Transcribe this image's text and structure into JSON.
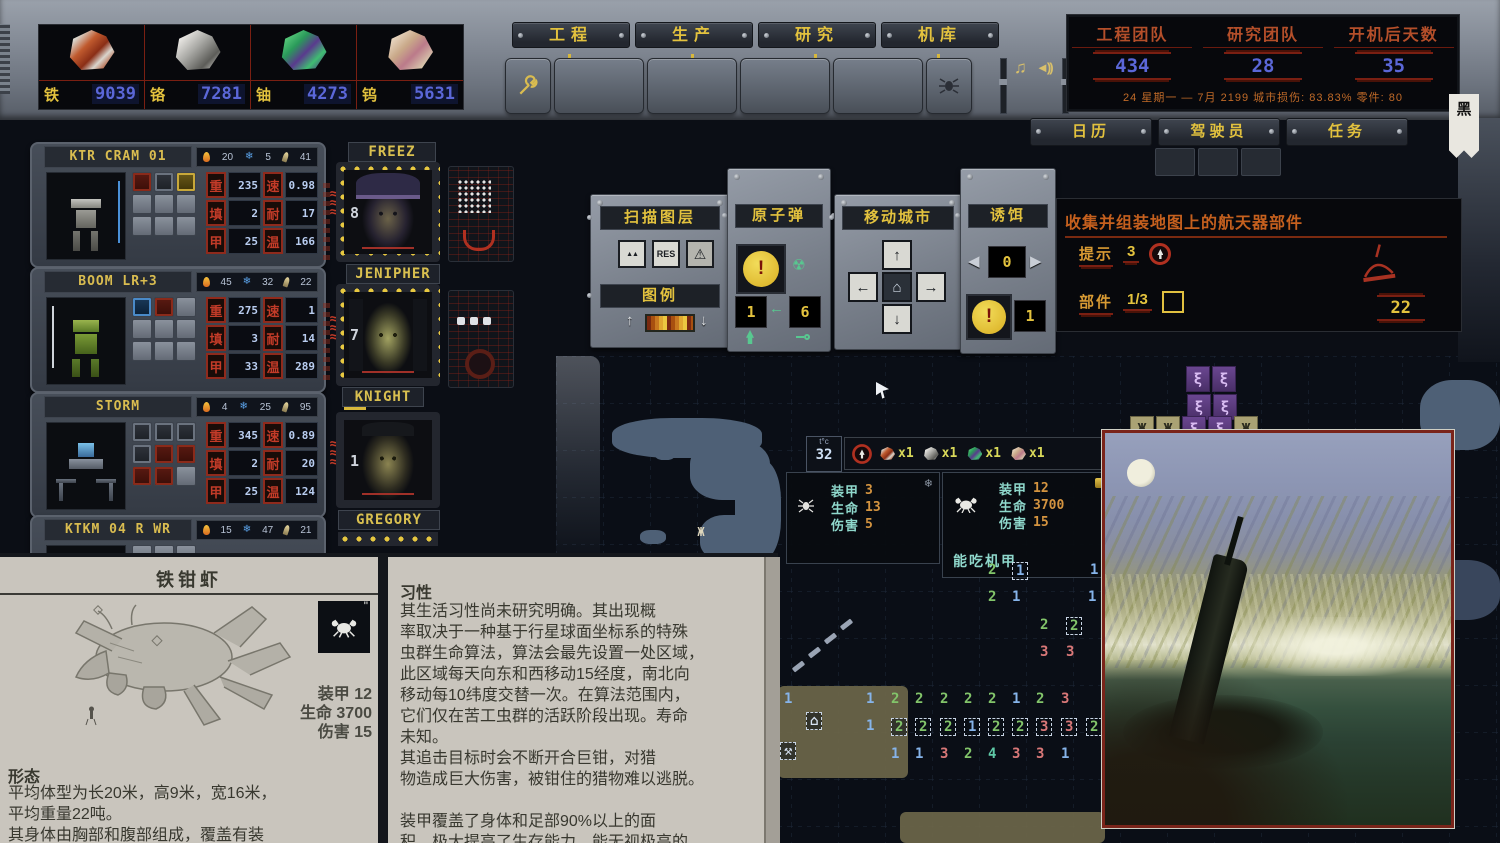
{
  "ui": {
    "stat_labels": {
      "w": "重",
      "s": "速",
      "f": "填",
      "n": "耐",
      "a": "甲",
      "t": "温"
    },
    "icons": {
      "music": "♫",
      "speaker": "◄))",
      "warning": "⚠",
      "mountains": "▲▲",
      "res": "RES",
      "arrow_up": "↑",
      "arrow_down": "↓",
      "arrow_left": "←",
      "arrow_right": "→",
      "home": "⌂",
      "tri_left": "◀",
      "tri_right": "▶",
      "radiation": "☢",
      "banner": "黑",
      "snow": "❄"
    }
  },
  "resources": [
    {
      "name": "铁",
      "value": "9039",
      "cls": "iron"
    },
    {
      "name": "铬",
      "value": "7281",
      "cls": "chrome"
    },
    {
      "name": "铀",
      "value": "4273",
      "cls": "uranium"
    },
    {
      "name": "钨",
      "value": "5631",
      "cls": "tungsten"
    }
  ],
  "tabs": [
    {
      "label": "工程"
    },
    {
      "label": "生产"
    },
    {
      "label": "研究"
    },
    {
      "label": "机库"
    }
  ],
  "counters": {
    "items": [
      {
        "label": "工程团队",
        "value": "434"
      },
      {
        "label": "研究团队",
        "value": "28"
      },
      {
        "label": "开机后天数",
        "value": "35"
      }
    ],
    "status_line": "24 星期一 — 7月 2199  城市损伤: 83.83%  零件: 80"
  },
  "menu_buttons": [
    {
      "label": "日历"
    },
    {
      "label": "驾驶员"
    },
    {
      "label": "任务"
    }
  ],
  "mechs": [
    {
      "name": "KTR CRAM 01",
      "heat": "20",
      "cold": "5",
      "ammo": "41",
      "mods": "m-red m-gray m-yellow",
      "stats": {
        "weight": "235",
        "speed": "0.98",
        "reload": "2",
        "endurance": "17",
        "armor": "25",
        "temp": "166"
      }
    },
    {
      "name": "BOOM LR+3",
      "heat": "45",
      "cold": "32",
      "ammo": "22",
      "mods": "m-blue m-red",
      "stats": {
        "weight": "275",
        "speed": "1",
        "reload": "3",
        "endurance": "14",
        "armor": "33",
        "temp": "289"
      }
    },
    {
      "name": "STORM",
      "heat": "4",
      "cold": "25",
      "ammo": "95",
      "mods": "m-gray m-gray m-gray m-gray m-red m-red m-red m-red",
      "stats": {
        "weight": "345",
        "speed": "0.89",
        "reload": "2",
        "endurance": "20",
        "armor": "25",
        "temp": "124"
      }
    },
    {
      "name": "KTKM 04 R WR",
      "heat": "15",
      "cold": "47",
      "ammo": "21",
      "mods": "",
      "stats": {
        "weight": "",
        "speed": "",
        "reload": "",
        "endurance": "",
        "armor": "",
        "temp": ""
      }
    }
  ],
  "pilots": [
    {
      "name": "FREEZ",
      "level": "8"
    },
    {
      "name": "JENIPHER",
      "level": "7"
    },
    {
      "name": "KNIGHT",
      "level": "1"
    },
    {
      "name": "GREGORY",
      "level": ""
    }
  ],
  "panels": {
    "scan": {
      "title": "扫描图层",
      "res_label": "RES"
    },
    "legend": {
      "title": "图例"
    },
    "atomic": {
      "title": "原子弹",
      "ready": "1",
      "stock": "6",
      "alert": "!"
    },
    "move_city": {
      "title": "移动城市"
    },
    "decoy": {
      "title": "诱饵",
      "selected": "0",
      "stock": "1",
      "alert": "!"
    }
  },
  "quest": {
    "title": "收集并组装地图上的航天器部件",
    "hint_label": "提示",
    "hint_value": "3",
    "parts_label": "部件",
    "parts_value": "1/3",
    "days_left": "22"
  },
  "map": {
    "tile_info": {
      "label": "t°c",
      "value": "32"
    },
    "loot": [
      {
        "cls": "iron",
        "qty": "x1"
      },
      {
        "cls": "chrome",
        "qty": "x1"
      },
      {
        "cls": "uranium",
        "qty": "x1"
      },
      {
        "cls": "tungsten",
        "qty": "x1"
      }
    ],
    "creature_small": {
      "armor_label": "装甲",
      "armor": "3",
      "hp_label": "生命",
      "hp": "13",
      "dmg_label": "伤害",
      "dmg": "5"
    },
    "creature_big": {
      "armor_label": "装甲",
      "armor": "12",
      "hp_label": "生命",
      "hp": "3700",
      "dmg_label": "伤害",
      "dmg": "15",
      "note": "能吃机甲"
    },
    "cells": [
      {
        "x": 988,
        "y": 562,
        "v": "2",
        "c": "g"
      },
      {
        "x": 1012,
        "y": 562,
        "v": "1",
        "c": "b",
        "bx": 1
      },
      {
        "x": 1090,
        "y": 562,
        "v": "1",
        "c": "b"
      },
      {
        "x": 988,
        "y": 589,
        "v": "2",
        "c": "g"
      },
      {
        "x": 1012,
        "y": 589,
        "v": "1",
        "c": "b"
      },
      {
        "x": 1088,
        "y": 589,
        "v": "1",
        "c": "b"
      },
      {
        "x": 1040,
        "y": 617,
        "v": "2",
        "c": "g"
      },
      {
        "x": 1066,
        "y": 617,
        "v": "2",
        "c": "g",
        "bx": 1
      },
      {
        "x": 1040,
        "y": 644,
        "v": "3",
        "c": "r"
      },
      {
        "x": 1066,
        "y": 644,
        "v": "3",
        "c": "r"
      },
      {
        "x": 784,
        "y": 691,
        "v": "1",
        "c": "b"
      },
      {
        "x": 866,
        "y": 691,
        "v": "1",
        "c": "b"
      },
      {
        "x": 891,
        "y": 691,
        "v": "2",
        "c": "g"
      },
      {
        "x": 915,
        "y": 691,
        "v": "2",
        "c": "g"
      },
      {
        "x": 940,
        "y": 691,
        "v": "2",
        "c": "g"
      },
      {
        "x": 964,
        "y": 691,
        "v": "2",
        "c": "g"
      },
      {
        "x": 988,
        "y": 691,
        "v": "2",
        "c": "g"
      },
      {
        "x": 1012,
        "y": 691,
        "v": "1",
        "c": "b"
      },
      {
        "x": 1036,
        "y": 691,
        "v": "2",
        "c": "g"
      },
      {
        "x": 1061,
        "y": 691,
        "v": "3",
        "c": "r"
      },
      {
        "x": 806,
        "y": 712,
        "v": "⌂",
        "c": "w",
        "bx": 1
      },
      {
        "x": 866,
        "y": 718,
        "v": "1",
        "c": "b"
      },
      {
        "x": 891,
        "y": 718,
        "v": "2",
        "c": "g",
        "bx": 1
      },
      {
        "x": 915,
        "y": 718,
        "v": "2",
        "c": "g",
        "bx": 1
      },
      {
        "x": 940,
        "y": 718,
        "v": "2",
        "c": "g",
        "bx": 1
      },
      {
        "x": 964,
        "y": 718,
        "v": "1",
        "c": "b",
        "bx": 1
      },
      {
        "x": 988,
        "y": 718,
        "v": "2",
        "c": "g",
        "bx": 1
      },
      {
        "x": 1012,
        "y": 718,
        "v": "2",
        "c": "g",
        "bx": 1
      },
      {
        "x": 1036,
        "y": 718,
        "v": "3",
        "c": "r",
        "bx": 1
      },
      {
        "x": 1061,
        "y": 718,
        "v": "3",
        "c": "r",
        "bx": 1
      },
      {
        "x": 1086,
        "y": 718,
        "v": "2",
        "c": "g",
        "bx": 1
      },
      {
        "x": 780,
        "y": 742,
        "v": "⚒",
        "c": "w",
        "bx": 1
      },
      {
        "x": 891,
        "y": 746,
        "v": "1",
        "c": "b"
      },
      {
        "x": 915,
        "y": 746,
        "v": "1",
        "c": "b"
      },
      {
        "x": 940,
        "y": 746,
        "v": "3",
        "c": "r"
      },
      {
        "x": 964,
        "y": 746,
        "v": "2",
        "c": "g"
      },
      {
        "x": 988,
        "y": 746,
        "v": "4",
        "c": "t"
      },
      {
        "x": 1012,
        "y": 746,
        "v": "3",
        "c": "r"
      },
      {
        "x": 1036,
        "y": 746,
        "v": "3",
        "c": "r"
      },
      {
        "x": 1061,
        "y": 746,
        "v": "1",
        "c": "b"
      }
    ],
    "sprites": [
      {
        "t": "tornado",
        "g": "ξ",
        "x": 1186,
        "y": 366
      },
      {
        "t": "tornado",
        "g": "ξ",
        "x": 1212,
        "y": 366
      },
      {
        "t": "tornado",
        "g": "ξ",
        "x": 1187,
        "y": 394
      },
      {
        "t": "tornado",
        "g": "ξ",
        "x": 1213,
        "y": 394
      },
      {
        "t": "bug",
        "g": "Ж",
        "x": 1130,
        "y": 416
      },
      {
        "t": "bug",
        "g": "Ж",
        "x": 1156,
        "y": 416
      },
      {
        "t": "tornado",
        "g": "ξ",
        "x": 1182,
        "y": 416
      },
      {
        "t": "tornado",
        "g": "ξ",
        "x": 1208,
        "y": 416
      },
      {
        "t": "bug",
        "g": "Ж",
        "x": 1234,
        "y": 416
      },
      {
        "t": "question",
        "g": "?",
        "x": 1188,
        "y": 790
      },
      {
        "t": "question",
        "g": "?",
        "x": 1216,
        "y": 790
      },
      {
        "t": "creature",
        "g": "Ж",
        "x": 690,
        "y": 520
      }
    ]
  },
  "encyclopedia": {
    "title": "铁钳虾",
    "stats_lines": [
      "装甲 12",
      "生命 3700",
      "伤害 15"
    ],
    "left_heading": "形态",
    "left_lines": [
      "平均体型为长20米，高9米，宽16米，",
      "平均重量22吨。",
      "其身体由胸部和腹部组成，覆盖有装"
    ],
    "right_heading": "习性",
    "right_lines": [
      "其生活习性尚未研究明确。其出现概",
      "率取决于一种基于行星球面坐标系的特殊",
      "虫群生命算法，算法会最先设置一处区域，",
      "此区域每天向东和西移动15经度，南北向",
      "移动每10纬度交替一次。在算法范围内，",
      "它们仅在苦工虫群的活跃阶段出现。寿命",
      "未知。",
      "其追击目标时会不断开合巨钳，对猎",
      "物造成巨大伤害，被钳住的猎物难以逃脱。",
      "",
      "装甲覆盖了身体和足部90%以上的面",
      "积，极大提高了生存能力，能无视极高的"
    ]
  }
}
